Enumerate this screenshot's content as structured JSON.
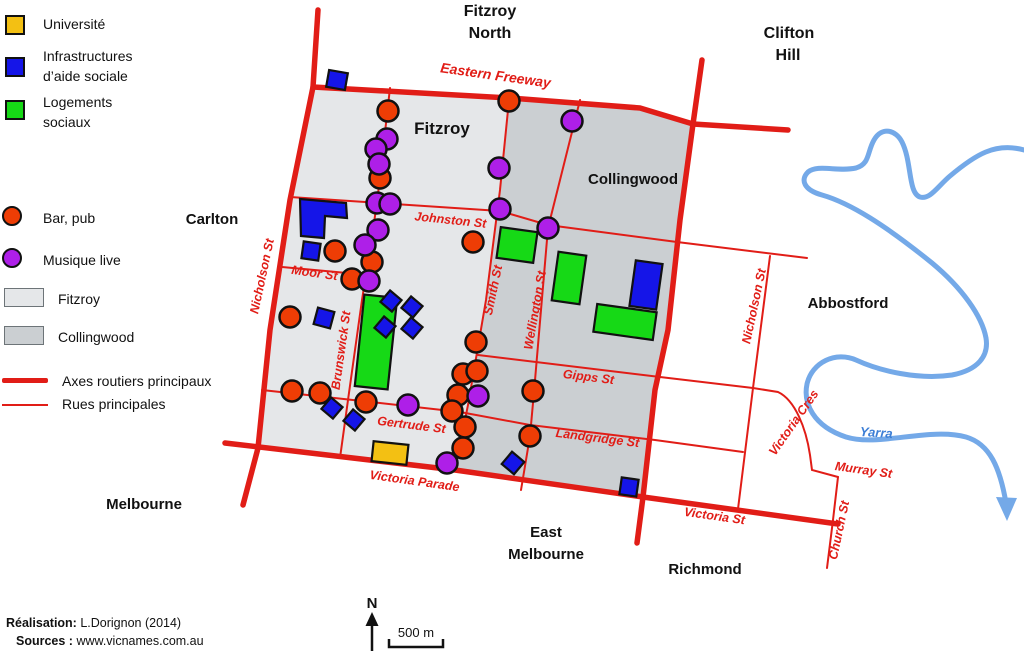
{
  "legend": {
    "university_label": "Université",
    "social_aid_line1": "Infrastructures",
    "social_aid_line2": "d’aide sociale",
    "social_housing_line1": "Logements",
    "social_housing_line2": "sociaux",
    "bar_label": "Bar, pub",
    "music_label": "Musique live",
    "fitzroy_label": "Fitzroy",
    "collingwood_label": "Collingwood",
    "main_axes_label": "Axes routiers principaux",
    "main_streets_label": "Rues principales"
  },
  "colors": {
    "road": "#e11d17",
    "bar": "#ee3d05",
    "music": "#ae1fe8",
    "social_aid": "#1515e8",
    "social_housing": "#16d916",
    "university": "#f3c013",
    "fitzroy_fill": "#e5e7e9",
    "collingwood_fill": "#cbcfd2",
    "river": "#74a9e8",
    "river_label": "#3d7fd6",
    "text": "#111111"
  },
  "map": {
    "regions": {
      "fitzroy": {
        "name": "Fitzroy",
        "path": "M313,87 L509,100 L500,190 L486,300 L468,405 L455,470 L258,447 L270,330 L290,200 Z"
      },
      "collingwood": {
        "name": "Collingwood",
        "path": "M509,100 L570,100 L640,108 L693,124 L680,220 L668,330 L655,390 L643,497 L455,470 L468,405 L486,300 L500,190 Z"
      }
    },
    "roads": {
      "main_axes": [
        {
          "id": "eastern-freeway",
          "path": "M313,87 L510,98 L640,108 L693,124 L788,130"
        },
        {
          "id": "nicholson-st-axis",
          "path": "M318,10 L313,87 L290,200 L270,330 L258,448 L243,505"
        },
        {
          "id": "hoddle-axis",
          "path": "M702,60 L693,124 L680,220 L668,330 L655,390 L643,497 L637,543"
        },
        {
          "id": "victoria-parade-victoria-st",
          "path": "M225,443 L455,470 L643,497 L838,524"
        }
      ],
      "main_streets": [
        {
          "id": "brunswick-st",
          "path": "M390,88 L377,203 L362,300 L348,400 L340,458"
        },
        {
          "id": "smith-st",
          "path": "M509,100 L500,190 L486,300 L468,405 L455,470"
        },
        {
          "id": "wellington-st-upper",
          "path": "M580,100 L548,228"
        },
        {
          "id": "wellington-st-lower",
          "path": "M548,228 L534,392 L530,436 L521,490"
        },
        {
          "id": "johnston-st",
          "path": "M290,197 L500,211 L548,225 L677,242 L807,258"
        },
        {
          "id": "moor-st",
          "path": "M282,267 L347,273"
        },
        {
          "id": "gertrude-st",
          "path": "M262,390 L380,403 L460,412"
        },
        {
          "id": "landgridge-st",
          "path": "M460,412 L530,425 L655,440 L743,452"
        },
        {
          "id": "gipps-st",
          "path": "M478,355 L660,377 L753,388"
        },
        {
          "id": "nicholson-st-east",
          "path": "M770,256 L753,388 L738,509"
        },
        {
          "id": "victoria-cres",
          "path": "M753,388 L778,392 C795,400 806,428 810,455 L812,470 L838,477"
        },
        {
          "id": "church-st",
          "path": "M838,477 L833,520 L827,568"
        }
      ]
    },
    "river": {
      "path": "M1024,150 C995,142 975,155 950,176 C938,186 930,200 920,197 C908,193 912,162 902,142 C896,130 882,126 874,140 C867,152 870,164 856,168 C838,172 818,164 808,172 C800,180 804,190 822,195 C850,203 885,225 932,263 C962,288 982,316 986,338 C989,356 978,370 952,375 C918,380 880,371 856,360 C836,351 812,362 807,384 C803,403 813,426 846,437 C878,447 930,427 966,437 C990,444 1000,468 1006,503",
      "arrow_points": "996,497 1017,498 1007,521",
      "label": {
        "text": "Yarra",
        "x": 876,
        "y": 437,
        "rot": 4,
        "size": 13
      }
    },
    "buildings": {
      "university": [
        {
          "x": 390,
          "y": 453,
          "w": 35,
          "h": 20,
          "rot": 6
        }
      ],
      "social_aid": [
        {
          "x": 337,
          "y": 80,
          "w": 19,
          "h": 17,
          "rot": 10
        },
        {
          "points": "300,199 346,203 347,218 325,216 324,238 301,236"
        },
        {
          "x": 311,
          "y": 251,
          "w": 17,
          "h": 17,
          "rot": 8
        },
        {
          "x": 324,
          "y": 318,
          "w": 17,
          "h": 17,
          "rot": 15
        },
        {
          "x": 391,
          "y": 301,
          "w": 15,
          "h": 15,
          "rot": 40
        },
        {
          "x": 412,
          "y": 307,
          "w": 15,
          "h": 15,
          "rot": 40
        },
        {
          "x": 385,
          "y": 327,
          "w": 15,
          "h": 15,
          "rot": 40
        },
        {
          "x": 412,
          "y": 328,
          "w": 15,
          "h": 15,
          "rot": 40
        },
        {
          "x": 332,
          "y": 408,
          "w": 15,
          "h": 15,
          "rot": 40
        },
        {
          "x": 354,
          "y": 420,
          "w": 15,
          "h": 15,
          "rot": 40
        },
        {
          "x": 513,
          "y": 463,
          "w": 16,
          "h": 16,
          "rot": 40
        },
        {
          "x": 629,
          "y": 487,
          "w": 17,
          "h": 17,
          "rot": 8
        },
        {
          "x": 646,
          "y": 285,
          "w": 27,
          "h": 46,
          "rot": 8
        }
      ],
      "social_housing": [
        {
          "x": 376,
          "y": 342,
          "w": 33,
          "h": 92,
          "rot": 6
        },
        {
          "x": 517,
          "y": 245,
          "w": 37,
          "h": 31,
          "rot": 8
        },
        {
          "x": 569,
          "y": 278,
          "w": 28,
          "h": 49,
          "rot": 8
        },
        {
          "x": 625,
          "y": 322,
          "w": 60,
          "h": 28,
          "rot": 8
        }
      ]
    },
    "venues": {
      "bars": [
        [
          388,
          111
        ],
        [
          380,
          178
        ],
        [
          372,
          262
        ],
        [
          352,
          279
        ],
        [
          335,
          251
        ],
        [
          290,
          317
        ],
        [
          292,
          391
        ],
        [
          320,
          393
        ],
        [
          366,
          402
        ],
        [
          509,
          101
        ],
        [
          473,
          242
        ],
        [
          476,
          342
        ],
        [
          463,
          374
        ],
        [
          477,
          371
        ],
        [
          458,
          395
        ],
        [
          452,
          411
        ],
        [
          465,
          427
        ],
        [
          463,
          448
        ],
        [
          533,
          391
        ],
        [
          530,
          436
        ]
      ],
      "music": [
        [
          387,
          139
        ],
        [
          376,
          149
        ],
        [
          379,
          164
        ],
        [
          377,
          203
        ],
        [
          390,
          204
        ],
        [
          378,
          230
        ],
        [
          365,
          245
        ],
        [
          369,
          281
        ],
        [
          572,
          121
        ],
        [
          499,
          168
        ],
        [
          500,
          209
        ],
        [
          548,
          228
        ],
        [
          478,
          396
        ],
        [
          408,
          405
        ],
        [
          447,
          463
        ]
      ]
    },
    "street_labels": [
      {
        "text": "Eastern Freeway",
        "x": 495,
        "y": 80,
        "rot": 8,
        "size": 14
      },
      {
        "text": "Nicholson St",
        "x": 266,
        "y": 277,
        "rot": -78,
        "size": 12.5
      },
      {
        "text": "Johnston St",
        "x": 450,
        "y": 224,
        "rot": 6,
        "size": 12.5
      },
      {
        "text": "Moor St",
        "x": 314,
        "y": 277,
        "rot": 8,
        "size": 12.5
      },
      {
        "text": "Brunswick St",
        "x": 345,
        "y": 351,
        "rot": -82,
        "size": 12.5
      },
      {
        "text": "Smith St",
        "x": 497,
        "y": 291,
        "rot": -78,
        "size": 12.5
      },
      {
        "text": "Wellington St",
        "x": 539,
        "y": 311,
        "rot": -80,
        "size": 12.5
      },
      {
        "text": "Gertrude St",
        "x": 411,
        "y": 429,
        "rot": 7,
        "size": 12.5
      },
      {
        "text": "Victoria Parade",
        "x": 414,
        "y": 485,
        "rot": 8,
        "size": 12.5
      },
      {
        "text": "Gipps St",
        "x": 588,
        "y": 381,
        "rot": 7,
        "size": 12.5
      },
      {
        "text": "Landgridge St",
        "x": 597,
        "y": 442,
        "rot": 7,
        "size": 12.5
      },
      {
        "text": "Nicholson St",
        "x": 758,
        "y": 307,
        "rot": -78,
        "size": 12.5
      },
      {
        "text": "Victoria Cres",
        "x": 797,
        "y": 425,
        "rot": -55,
        "size": 12.5
      },
      {
        "text": "Murray St",
        "x": 863,
        "y": 474,
        "rot": 8,
        "size": 12.5
      },
      {
        "text": "Church St",
        "x": 843,
        "y": 531,
        "rot": -78,
        "size": 12.5
      },
      {
        "text": "Victoria St",
        "x": 714,
        "y": 520,
        "rot": 8,
        "size": 12.5
      }
    ],
    "area_labels": [
      {
        "text": "Fitzroy",
        "x": 490,
        "y": 16,
        "size": 16
      },
      {
        "text": "North",
        "x": 490,
        "y": 38,
        "size": 16
      },
      {
        "text": "Clifton",
        "x": 789,
        "y": 38,
        "size": 16
      },
      {
        "text": "Hill",
        "x": 788,
        "y": 60,
        "size": 16
      },
      {
        "text": "Carlton",
        "x": 212,
        "y": 224,
        "size": 15
      },
      {
        "text": "Fitzroy",
        "x": 442,
        "y": 134,
        "size": 17
      },
      {
        "text": "Collingwood",
        "x": 633,
        "y": 184,
        "size": 15
      },
      {
        "text": "Abbostford",
        "x": 848,
        "y": 308,
        "size": 15
      },
      {
        "text": "Melbourne",
        "x": 144,
        "y": 509,
        "size": 15
      },
      {
        "text": "East",
        "x": 546,
        "y": 537,
        "size": 15
      },
      {
        "text": "Melbourne",
        "x": 546,
        "y": 559,
        "size": 15
      },
      {
        "text": "Richmond",
        "x": 705,
        "y": 574,
        "size": 15
      }
    ]
  },
  "annotations": {
    "north": {
      "label": "N",
      "x": 372,
      "label_y": 608,
      "tip_y": 612,
      "shaft_top": 625,
      "shaft_bottom": 651
    },
    "scale": {
      "label": "500 m",
      "label_x": 416,
      "label_y": 637,
      "x1": 389,
      "x2": 443,
      "y": 647,
      "tick": 8
    }
  },
  "credits": {
    "realisation_label": "Réalisation:",
    "realisation_value": " L.Dorignon (2014)",
    "sources_label": "Sources : ",
    "sources_value": "www.vicnames.com.au"
  }
}
